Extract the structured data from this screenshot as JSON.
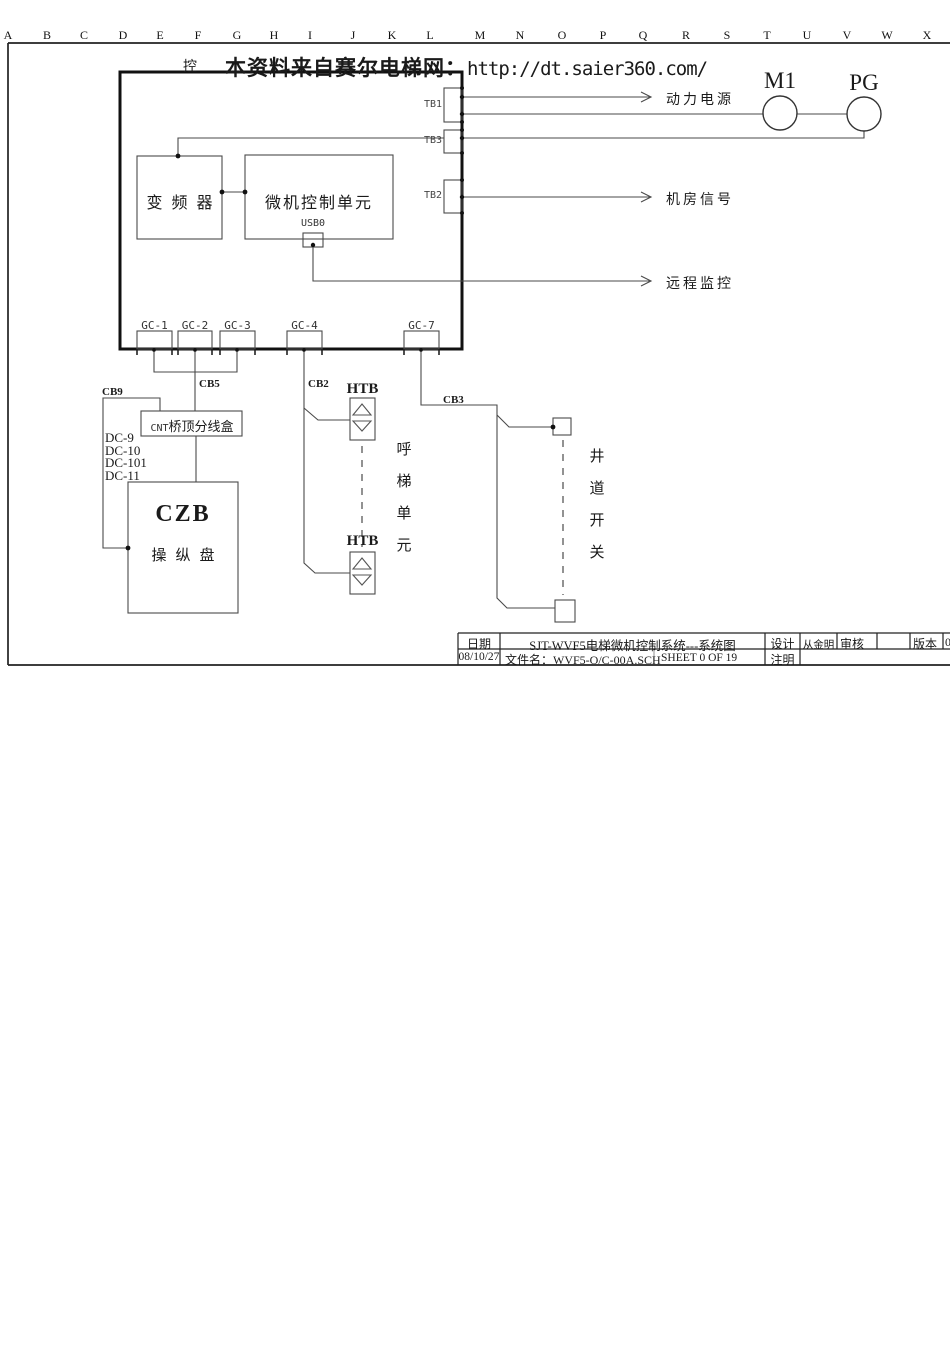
{
  "ruler": {
    "letters": [
      "A",
      "B",
      "C",
      "D",
      "E",
      "F",
      "G",
      "H",
      "I",
      "J",
      "K",
      "L",
      "M",
      "N",
      "O",
      "P",
      "Q",
      "R",
      "S",
      "T",
      "U",
      "V",
      "W",
      "X"
    ]
  },
  "watermark": {
    "prefix": "本资料来自赛尔电梯网：",
    "url": "http://dt.saier360.com/"
  },
  "cabinet": {
    "corner_label": "控",
    "inverter": "变频器",
    "mcu": "微机控制单元",
    "usb": "USB0"
  },
  "terminals": {
    "tb1": "TB1",
    "tb3": "TB3",
    "tb2": "TB2"
  },
  "outputs": {
    "power": "动力电源",
    "machine_room": "机房信号",
    "remote": "远程监控"
  },
  "machine": {
    "m1": "M1",
    "pg": "PG"
  },
  "gc": {
    "gc1": "GC-1",
    "gc2": "GC-2",
    "gc3": "GC-3",
    "gc4": "GC-4",
    "gc7": "GC-7"
  },
  "cables": {
    "cb9": "CB9",
    "cb5": "CB5",
    "cb2": "CB2",
    "cb3": "CB3"
  },
  "cnt": {
    "prefix": "CNT",
    "name": "桥顶分线盒"
  },
  "dc": [
    "DC-9",
    "DC-10",
    "DC-101",
    "DC-11"
  ],
  "czb": {
    "code": "CZB",
    "name": "操纵盘"
  },
  "htb": {
    "label": "HTB",
    "unit": "呼梯单元"
  },
  "shaft": {
    "label": "井道开关"
  },
  "titleblock": {
    "date_label": "日期",
    "date": "08/10/27",
    "title": "SJT-WVF5电梯微机控制系统---系统图",
    "file_label_and_name": "文件名：WVF5-O/C-00A.SCH",
    "sheet": "SHEET 0 OF 19",
    "design_label": "设计",
    "designer": "从金明",
    "review_label": "审核",
    "note_label": "注明",
    "version_label": "版本",
    "version_partial": "0"
  }
}
